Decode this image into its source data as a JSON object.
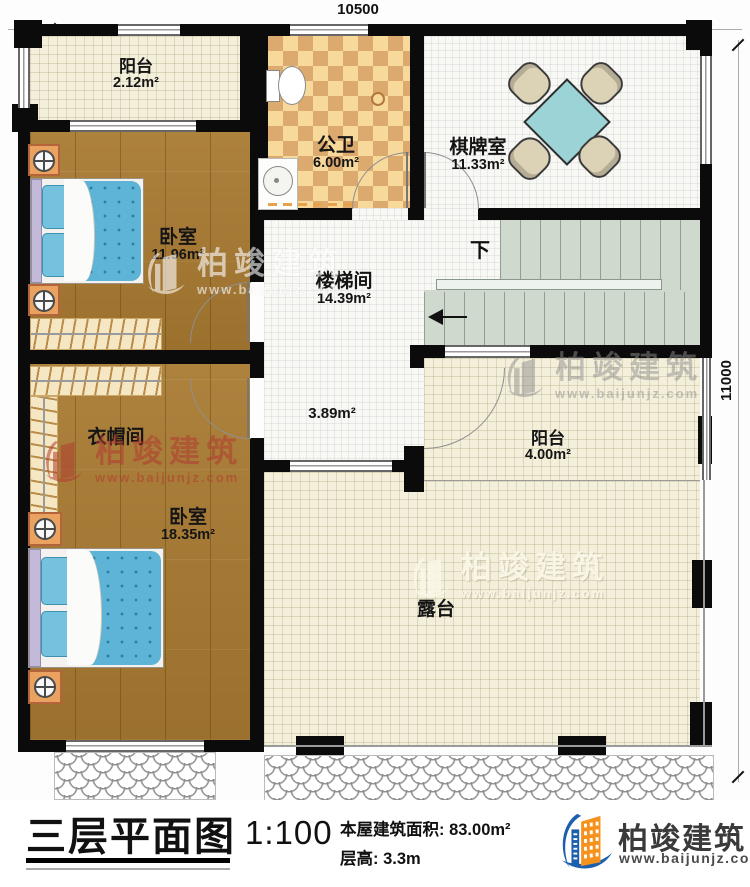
{
  "dimensions": {
    "top": "10500",
    "right": "11000"
  },
  "rooms": {
    "balcony_top": {
      "name": "阳台",
      "area": "2.12m²"
    },
    "bathroom": {
      "name": "公卫",
      "area": "6.00m²"
    },
    "chess_room": {
      "name": "棋牌室",
      "area": "11.33m²"
    },
    "bedroom_top": {
      "name": "卧室",
      "area": "11.96m²"
    },
    "stairwell": {
      "name": "楼梯间",
      "area": "14.39m²",
      "sub_area": "3.89m²",
      "down_label": "下"
    },
    "cloakroom": {
      "name": "衣帽间"
    },
    "bedroom_bottom": {
      "name": "卧室",
      "area": "18.35m²"
    },
    "balcony_right": {
      "name": "阳台",
      "area": "4.00m²"
    },
    "terrace": {
      "name": "露台"
    }
  },
  "title_block": {
    "drawing_title": "三层平面图",
    "scale": "1:100",
    "building_area": "本屋建筑面积: 83.00m²",
    "floor_height": "层高: 3.3m"
  },
  "branding": {
    "company": "柏竣建筑",
    "website": "www.baijunjz.com",
    "brand_blue": "#1c5fae",
    "brand_orange": "#f5921e"
  },
  "colors": {
    "wall": "#0b0b0b",
    "wood_floor": "#a87a31",
    "tile_light": "#f7d99c",
    "tile_dark": "#dcaa6e",
    "stair": "#cfd9cd",
    "table_teal": "#9bd3d6",
    "bed_blue": "#5db4d6",
    "watermark_red": "#b23b30"
  }
}
